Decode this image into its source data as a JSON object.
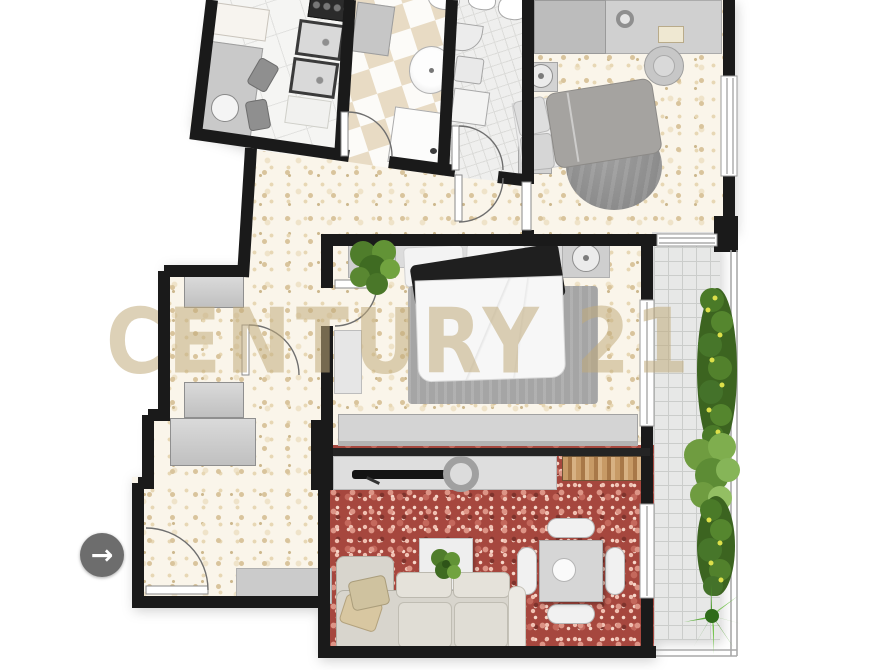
{
  "watermark": {
    "text": "CENTURY 21"
  },
  "entrance_indicator": {
    "icon": "→"
  },
  "colors": {
    "wall": "#1a1a1a",
    "floor_beige_base": "#faf5ea",
    "floor_beige_speckle": "#d9c49c",
    "floor_living_red": "#a6473e",
    "floor_checker_tan": "#e8dbc4",
    "balcony_tile": "#e7e8e7",
    "plant_green": "#4a7a28",
    "plant_flower_yellow": "#dde04a",
    "furniture_gray": "#d0d0d0",
    "arrow_button_bg": "#6d6d6d"
  }
}
